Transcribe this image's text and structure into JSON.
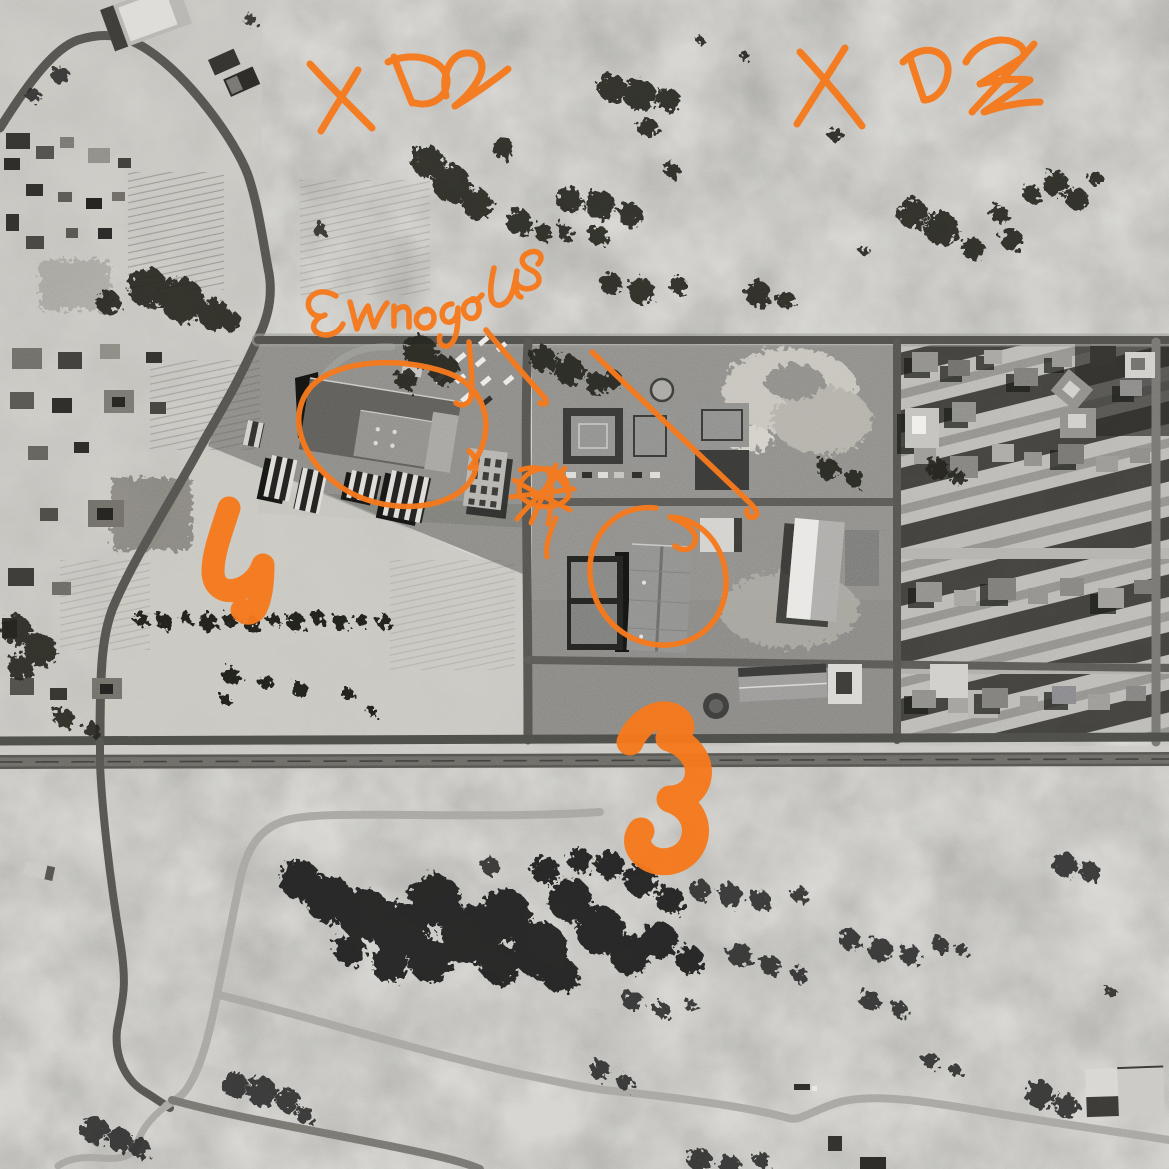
{
  "map": {
    "style": "grayscale-aerial-satellite-imagery",
    "annotation_color": "#f5791d"
  },
  "annotations": {
    "xd2_left": {
      "label": "XD2"
    },
    "xd2_right": {
      "label": "XD2"
    },
    "handwritten_note": {
      "label": "EwnegoUS"
    },
    "number_west_field": {
      "label": "4"
    },
    "number_highway": {
      "label": "3"
    },
    "warehouse_ellipse": {
      "label": "ellipse highlight around large warehouse"
    },
    "storage_circle": {
      "label": "circle highlight around storage building"
    },
    "cross_scribble": {
      "label": "scribbled cross mark"
    },
    "leader_lines": {
      "label": "leader lines from note"
    }
  }
}
